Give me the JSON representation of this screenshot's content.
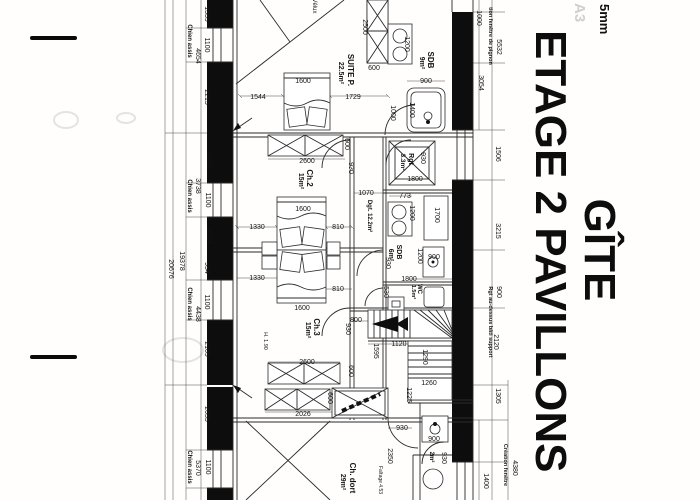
{
  "title_block": {
    "line1": "GÎTE",
    "line2": "ETAGE 2 PAVILLONS"
  },
  "corner_note": "5mm",
  "watermark": "A3",
  "rooms": [
    {
      "label": "SUITE P.",
      "area": "22.5m²"
    },
    {
      "label": "Ch.2",
      "area": "15m²"
    },
    {
      "label": "Ch.3",
      "area": "15m²"
    },
    {
      "label": "SDB",
      "area": "9m²"
    },
    {
      "label": "SDB",
      "area": "6m²"
    },
    {
      "label": "WC",
      "area": "1.5m²"
    },
    {
      "label": "Rgt",
      "area": "3.3m²"
    },
    {
      "label": "Dgt.",
      "area": "12.2m²"
    },
    {
      "label": "Ch. dort",
      "area": "29m²"
    },
    {
      "label": "2m²",
      "area": "2m²"
    }
  ],
  "plan_labels": [
    {
      "t": "1339",
      "x": 205,
      "y": 14,
      "r": 1
    },
    {
      "t": "1100",
      "x": 205,
      "y": 45,
      "r": 1
    },
    {
      "t": "2215",
      "x": 205,
      "y": 97,
      "r": 1
    },
    {
      "t": "1698",
      "x": 207,
      "y": 160,
      "r": 1
    },
    {
      "t": "1100",
      "x": 206,
      "y": 200,
      "r": 1
    },
    {
      "t": "1214",
      "x": 207,
      "y": 236,
      "r": 1
    },
    {
      "t": "954",
      "x": 205,
      "y": 268,
      "r": 1
    },
    {
      "t": "1100",
      "x": 205,
      "y": 302,
      "r": 1
    },
    {
      "t": "2109",
      "x": 205,
      "y": 349,
      "r": 1
    },
    {
      "t": "2055",
      "x": 205,
      "y": 414,
      "r": 1
    },
    {
      "t": "1100",
      "x": 206,
      "y": 467,
      "r": 1
    },
    {
      "t": "4654",
      "x": 196,
      "y": 56,
      "r": 1
    },
    {
      "t": "3738",
      "x": 196,
      "y": 186,
      "r": 1
    },
    {
      "t": "4438",
      "x": 196,
      "y": 314,
      "r": 1
    },
    {
      "t": "5370",
      "x": 196,
      "y": 468,
      "r": 1
    },
    {
      "t": "Chien assis",
      "x": 188,
      "y": 41,
      "r": 1,
      "b": 1,
      "fs": 6,
      "n": "chien-assis-label"
    },
    {
      "t": "Chien assis",
      "x": 188,
      "y": 196,
      "r": 1,
      "b": 1,
      "fs": 6,
      "n": "chien-assis-label"
    },
    {
      "t": "Chien assis",
      "x": 188,
      "y": 304,
      "r": 1,
      "b": 1,
      "fs": 6,
      "n": "chien-assis-label"
    },
    {
      "t": "Chien assis",
      "x": 188,
      "y": 467,
      "r": 1,
      "b": 1,
      "fs": 6,
      "n": "chien-assis-label"
    },
    {
      "t": "19378",
      "x": 180,
      "y": 261,
      "r": 1
    },
    {
      "t": "20676",
      "x": 169,
      "y": 269,
      "r": 1
    },
    {
      "t": "Vélux",
      "x": 313,
      "y": 6,
      "r": 1,
      "fs": 6
    },
    {
      "t": "2500",
      "x": 363,
      "y": 27,
      "r": 1
    },
    {
      "t": "600",
      "x": 374,
      "y": 70
    },
    {
      "t": "SUITE P.",
      "x": 348,
      "y": 70,
      "r": 1,
      "b": 1,
      "fs": 8,
      "n": "room-label-suite-p"
    },
    {
      "t": "22.5m²",
      "x": 339,
      "y": 73,
      "r": 1,
      "b": 1,
      "fs": 7,
      "n": "room-area-suite-p"
    },
    {
      "t": "1544",
      "x": 258,
      "y": 99
    },
    {
      "t": "1600",
      "x": 303,
      "y": 83
    },
    {
      "t": "1729",
      "x": 353,
      "y": 99
    },
    {
      "t": "1000",
      "x": 391,
      "y": 113,
      "r": 1
    },
    {
      "t": "2600",
      "x": 307,
      "y": 163
    },
    {
      "t": "600",
      "x": 345,
      "y": 144,
      "r": 1
    },
    {
      "t": "930",
      "x": 349,
      "y": 168,
      "r": 1
    },
    {
      "t": "1200",
      "x": 405,
      "y": 44,
      "r": 1
    },
    {
      "t": "SDB",
      "x": 428,
      "y": 60,
      "r": 1,
      "b": 1,
      "fs": 8,
      "n": "room-label-sdb9"
    },
    {
      "t": "9m²",
      "x": 420,
      "y": 63,
      "r": 1,
      "b": 1,
      "fs": 7,
      "n": "room-area-sdb9"
    },
    {
      "t": "900",
      "x": 426,
      "y": 83
    },
    {
      "t": "1400",
      "x": 410,
      "y": 110,
      "r": 1
    },
    {
      "t": "tion fenêtre de pignon",
      "x": 489,
      "y": 36,
      "r": 1,
      "b": 1,
      "fs": 5.5
    },
    {
      "t": "1000",
      "x": 477,
      "y": 18,
      "r": 1
    },
    {
      "t": "5532",
      "x": 497,
      "y": 47,
      "r": 1
    },
    {
      "t": "3054",
      "x": 479,
      "y": 83,
      "r": 1
    },
    {
      "t": "Rgt",
      "x": 409,
      "y": 159,
      "r": 1,
      "b": 1,
      "fs": 7,
      "n": "room-label-rgt"
    },
    {
      "t": "3.3m²",
      "x": 401,
      "y": 162,
      "r": 1,
      "b": 1,
      "fs": 6.5,
      "n": "room-area-rgt"
    },
    {
      "t": "930",
      "x": 421,
      "y": 158,
      "r": 1
    },
    {
      "t": "1800",
      "x": 415,
      "y": 181
    },
    {
      "t": "773",
      "x": 405,
      "y": 198
    },
    {
      "t": "1070",
      "x": 366,
      "y": 195
    },
    {
      "t": "Dgt. 12.2m²",
      "x": 368,
      "y": 216,
      "r": 1,
      "b": 1,
      "fs": 6,
      "n": "room-label-dgt"
    },
    {
      "t": "1506",
      "x": 496,
      "y": 154,
      "r": 1
    },
    {
      "t": "Ch.2",
      "x": 307,
      "y": 178,
      "r": 1,
      "b": 1,
      "fs": 8,
      "n": "room-label-ch2"
    },
    {
      "t": "15m²",
      "x": 299,
      "y": 181,
      "r": 1,
      "b": 1,
      "fs": 7,
      "n": "room-area-ch2"
    },
    {
      "t": "1330",
      "x": 257,
      "y": 229
    },
    {
      "t": "810",
      "x": 338,
      "y": 229
    },
    {
      "t": "1600",
      "x": 303,
      "y": 211
    },
    {
      "t": "1200",
      "x": 410,
      "y": 213,
      "r": 1
    },
    {
      "t": "1700",
      "x": 435,
      "y": 215,
      "r": 1
    },
    {
      "t": "SDB",
      "x": 397,
      "y": 252,
      "r": 1,
      "b": 1,
      "fs": 7,
      "n": "room-label-sdb6"
    },
    {
      "t": "6m²",
      "x": 389,
      "y": 255,
      "r": 1,
      "b": 1,
      "fs": 7,
      "n": "room-area-sdb6"
    },
    {
      "t": "1200",
      "x": 418,
      "y": 256,
      "r": 1
    },
    {
      "t": "900",
      "x": 434,
      "y": 259
    },
    {
      "t": "930",
      "x": 386,
      "y": 263,
      "r": 1
    },
    {
      "t": "530",
      "x": 384,
      "y": 292,
      "r": 1
    },
    {
      "t": "3215",
      "x": 496,
      "y": 231,
      "r": 1
    },
    {
      "t": "900",
      "x": 497,
      "y": 292,
      "r": 1
    },
    {
      "t": "Rgt au-dessus bâti support",
      "x": 489,
      "y": 322,
      "r": 1,
      "b": 1,
      "fs": 5.5
    },
    {
      "t": "2120",
      "x": 494,
      "y": 342,
      "r": 1
    },
    {
      "t": "1330",
      "x": 257,
      "y": 280
    },
    {
      "t": "810",
      "x": 338,
      "y": 291
    },
    {
      "t": "1600",
      "x": 302,
      "y": 310
    },
    {
      "t": "Ch.3",
      "x": 314,
      "y": 327,
      "r": 1,
      "b": 1,
      "fs": 8,
      "n": "room-label-ch3"
    },
    {
      "t": "15m²",
      "x": 306,
      "y": 330,
      "r": 1,
      "b": 1,
      "fs": 7,
      "n": "room-area-ch3"
    },
    {
      "t": "H. 1.90",
      "x": 264,
      "y": 341,
      "r": 1,
      "fs": 5.5
    },
    {
      "t": "930",
      "x": 346,
      "y": 329,
      "r": 1
    },
    {
      "t": "2600",
      "x": 307,
      "y": 364
    },
    {
      "t": "600",
      "x": 349,
      "y": 371,
      "r": 1
    },
    {
      "t": "2026",
      "x": 303,
      "y": 416
    },
    {
      "t": "600",
      "x": 328,
      "y": 398,
      "r": 1
    },
    {
      "t": "1800",
      "x": 409,
      "y": 281
    },
    {
      "t": "WC",
      "x": 418,
      "y": 289,
      "r": 1,
      "b": 1,
      "fs": 6,
      "n": "room-label-wc"
    },
    {
      "t": "1.5m²",
      "x": 412,
      "y": 292,
      "r": 1,
      "b": 1,
      "fs": 5.5,
      "n": "room-area-wc"
    },
    {
      "t": "800",
      "x": 356,
      "y": 322
    },
    {
      "t": "1120",
      "x": 399,
      "y": 346
    },
    {
      "t": "1595",
      "x": 374,
      "y": 351,
      "r": 1
    },
    {
      "t": "1290",
      "x": 423,
      "y": 357,
      "r": 1
    },
    {
      "t": "1260",
      "x": 429,
      "y": 385
    },
    {
      "t": "1225",
      "x": 407,
      "y": 395,
      "r": 1
    },
    {
      "t": "1305",
      "x": 496,
      "y": 396,
      "r": 1
    },
    {
      "t": "930",
      "x": 402,
      "y": 430
    },
    {
      "t": "900",
      "x": 434,
      "y": 441
    },
    {
      "t": "2350",
      "x": 388,
      "y": 456,
      "r": 1
    },
    {
      "t": "2m²",
      "x": 430,
      "y": 457,
      "r": 1,
      "b": 1,
      "fs": 6,
      "n": "room-label-2m2"
    },
    {
      "t": "930",
      "x": 442,
      "y": 458,
      "r": 1
    },
    {
      "t": "Ch. dort",
      "x": 350,
      "y": 478,
      "r": 1,
      "b": 1,
      "fs": 8,
      "n": "room-label-ch-dort"
    },
    {
      "t": "29m²",
      "x": 341,
      "y": 482,
      "r": 1,
      "b": 1,
      "fs": 7,
      "n": "room-area-ch-dort"
    },
    {
      "t": "Faîtage 4.53",
      "x": 379,
      "y": 480,
      "r": 1,
      "fs": 5
    },
    {
      "t": "Création fenêtre",
      "x": 504,
      "y": 465,
      "r": 1,
      "b": 1,
      "fs": 5.5
    },
    {
      "t": "4380",
      "x": 513,
      "y": 468,
      "r": 1
    },
    {
      "t": "1400",
      "x": 484,
      "y": 481,
      "r": 1
    }
  ]
}
